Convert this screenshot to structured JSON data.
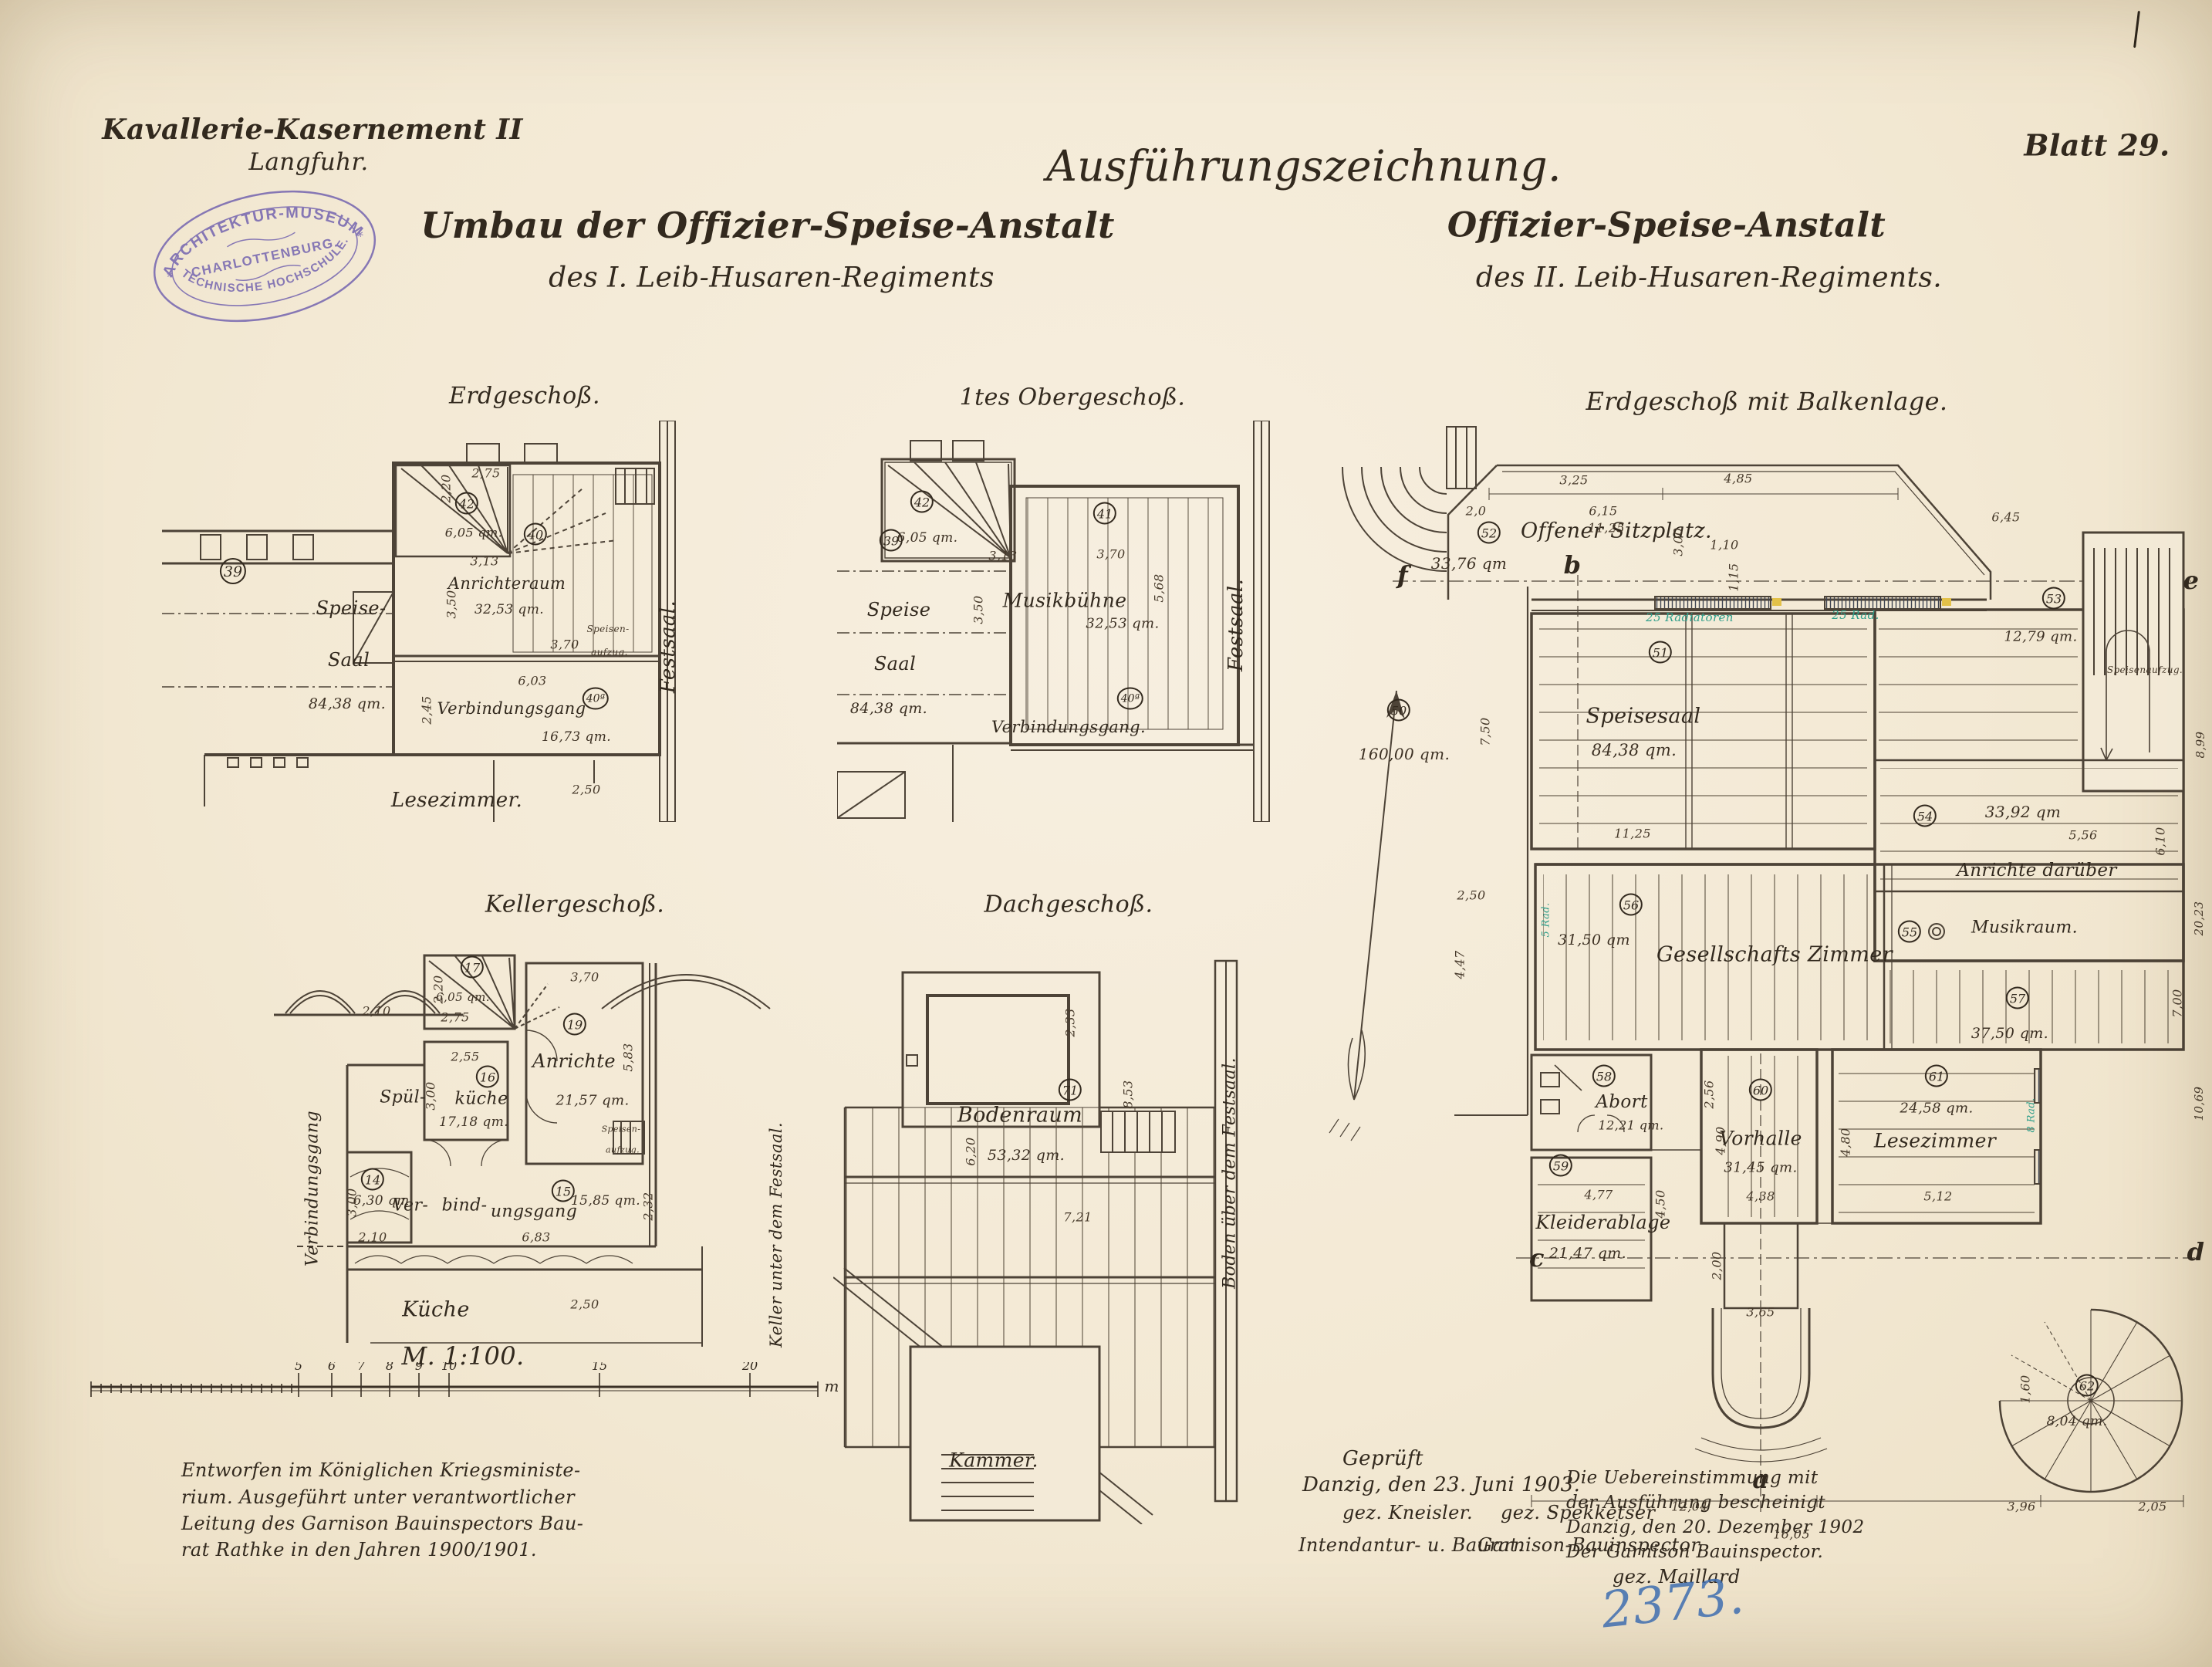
{
  "colors": {
    "paper": "#f4ebd8",
    "ink": "#32291e",
    "stamp_purple": "#6f5fae",
    "archive_blue": "#3f6eb0",
    "note_teal": "#2e9e8a",
    "mark_yellow": "#e2bd3a"
  },
  "header": {
    "project_line1": "Kavallerie-Kasernement II",
    "project_line2": "Langfuhr.",
    "drawing_type": "Ausführungszeichnung.",
    "sheet": "Blatt 29.",
    "title_left_line1": "Umbau der Offizier-Speise-Anstalt",
    "title_left_line2": "des I. Leib-Husaren-Regiments",
    "title_right_line1": "Offizier-Speise-Anstalt",
    "title_right_line2": "des II. Leib-Husaren-Regiments."
  },
  "stamp": {
    "line1": "ARCHITEKTUR-MUSEUM",
    "line2": "CHARLOTTENBURG.",
    "line3": "TECHNISCHE HOCHSCHULE.",
    "star": "*"
  },
  "plans": {
    "eg": {
      "caption": "Erdgeschoß.",
      "r39_no": "39",
      "r39_l1": "Speise-",
      "r39_l2": "Saal",
      "r39_area": "84,38 qm.",
      "r40_no": "40",
      "r40_name": "Anrichteraum",
      "r40_area": "32,53 qm.",
      "r40a_no": "40ª",
      "r40a_name": "Verbindungsgang",
      "r40a_area": "16,73 qm.",
      "r42_no": "42",
      "r42_area": "6,05 qm.",
      "lesezimmer": "Lesezimmer.",
      "festsaal": "Festsaal.",
      "aufzug_l1": "Speisen-",
      "aufzug_l2": "aufzug.",
      "dims": {
        "d275": "2,75",
        "d220": "2,20",
        "d313": "3,13",
        "d370": "3,70",
        "d350": "3,50",
        "d603": "6,03",
        "d245": "2,45",
        "d250": "2,50"
      }
    },
    "og": {
      "caption": "1tes Obergeschoß.",
      "r42_no": "42",
      "r42_area": "6,05 qm.",
      "r41_no": "41",
      "r41_name": "Musikbühne",
      "r41_area": "32,53 qm.",
      "r39_no": "39",
      "r39_l1": "Speise",
      "r39_l2": "Saal",
      "r39_area": "84,38 qm.",
      "r40a_no": "40ª",
      "gang": "Verbindungsgang.",
      "festsaal": "Festsaal.",
      "dims": {
        "d313": "3,13",
        "d370": "3,70",
        "d350": "3,50",
        "d568": "5,68"
      }
    },
    "kg": {
      "caption": "Kellergeschoß.",
      "r17_no": "17",
      "r17_area": "6,05 qm.",
      "r16_no": "16",
      "r16_l1": "Spül-",
      "r16_l2": "küche",
      "r16_area": "17,18 qm.",
      "r19_no": "19",
      "r19_name": "Anrichte",
      "r19_area": "21,57 qm.",
      "r14_no": "14",
      "r14_area": "6,30 qm.",
      "r15_no": "15",
      "r15_area": "15,85 qm.",
      "gang_l1": "Ver-",
      "gang_l2": "bind-",
      "gang_l3": "ungsgang",
      "kueche": "Küche",
      "gang_left": "Verbindungsgang",
      "keller_right": "Keller unter dem Festsaal.",
      "aufzug_l1": "Speisen-",
      "aufzug_l2": "aufzug.",
      "dims": {
        "d275": "2,75",
        "d220": "2,20",
        "d255": "2,55",
        "d300a": "3,00",
        "d370": "3,70",
        "d583": "5,83",
        "d210a": "2,10",
        "d300b": "3,00",
        "d232": "2,32",
        "d210b": "2,10",
        "d683": "6,83",
        "d250": "2,50"
      }
    },
    "dg": {
      "caption": "Dachgeschoß.",
      "r71_no": "71",
      "name": "Bodenraum",
      "area": "53,32 qm.",
      "kammer": "Kammer.",
      "boden_right": "Boden über dem Festsaal.",
      "dims": {
        "d233": "2,33",
        "d853": "8,53",
        "d620": "6,20",
        "d721": "7,21"
      }
    },
    "bk": {
      "caption": "Erdgeschoß mit Balkenlage.",
      "r50_no": "50",
      "r50_area": "160,00 qm.",
      "r51_no": "51",
      "r51_name": "Speisesaal",
      "r51_area": "84,38 qm.",
      "r52_no": "52",
      "r52_name": "Offener Sitzplatz.",
      "r52_area": "33,76 qm",
      "r53_no": "53",
      "r53_area": "12,79 qm.",
      "r54_no": "54",
      "r54_area": "33,92 qm",
      "r54_name": "Anrichte darüber",
      "r55_no": "55",
      "r55_name": "Musikraum.",
      "r56_no": "56",
      "r56_area": "31,50 qm",
      "r57_no": "57",
      "r57_area": "37,50 qm.",
      "gesellschaft": "Gesellschafts Zimmer",
      "r58_no": "58",
      "r58_name": "Abort",
      "r58_area": "12,21 qm.",
      "r59_no": "59",
      "r59_name": "Kleiderablage",
      "r59_area": "21,47 qm.",
      "r60_no": "60",
      "r60_name": "Vorhalle",
      "r60_area": "31,45 qm.",
      "r61_no": "61",
      "r61_name": "Lesezimmer",
      "r61_area": "24,58 qm.",
      "r62_no": "62",
      "r62_area": "8,04 qm.",
      "aufzug": "Speisenaufzug.",
      "rad1": "25 Radiatoren",
      "rad2": "25 Rad.",
      "rad3": "8 Rad.",
      "rad4": "5 Rad.",
      "letters": {
        "a": "a",
        "b": "b",
        "c": "c",
        "d": "d",
        "e": "e",
        "f": "f"
      },
      "dims": {
        "d20": "2,0",
        "d325": "3,25",
        "d485": "4,85",
        "d615": "6,15",
        "d1125a": "11,25",
        "d300": "3,00",
        "d110": "1,10",
        "d115": "1,15",
        "d645": "6,45",
        "d750": "7,50",
        "d1125b": "11,25",
        "d556": "5,56",
        "d610": "6,10",
        "d250": "2,50",
        "d447": "4,47",
        "d256": "2,56",
        "d477": "4,77",
        "d450": "4,50",
        "d438": "4,38",
        "d490": "4,90",
        "d200": "2,00",
        "d365": "3,65",
        "d512": "5,12",
        "d480": "4,80",
        "d160": "1,60",
        "d899": "8,99",
        "d2023": "20,23",
        "d1069": "10,69",
        "d700": "7,00",
        "d1204": "12,04",
        "d1605": "16,05",
        "d396": "3,96",
        "d205": "2,05"
      }
    }
  },
  "scale": {
    "label": "M. 1:100.",
    "ticks": [
      "5",
      "6",
      "7",
      "8",
      "9",
      "10",
      "15",
      "20"
    ],
    "unit": "m"
  },
  "footer": {
    "left_l1": "Entworfen im Königlichen Kriegsministe-",
    "left_l2": "rium. Ausgeführt unter verantwortlicher",
    "left_l3": "Leitung des Garnison Bauinspectors Bau-",
    "left_l4": "rat Rathke in den Jahren 1900/1901.",
    "center_title": "Geprüft",
    "center_l1": "Danzig, den 23. Juni 1903.",
    "sig1": "gez. Kneisler.",
    "sig2": "gez. Spekketser",
    "role1": "Intendantur- u. Baurat.",
    "role2": "Garnison-Bauinspector.",
    "right_l1": "Die Uebereinstimmung mit",
    "right_l2": "der Ausführung bescheinigt",
    "right_l3": "Danzig, den 20. Dezember 1902",
    "right_l4": "Der Garnison Bauinspector.",
    "right_l5": "gez. Maillard",
    "archive_no": "2373."
  }
}
